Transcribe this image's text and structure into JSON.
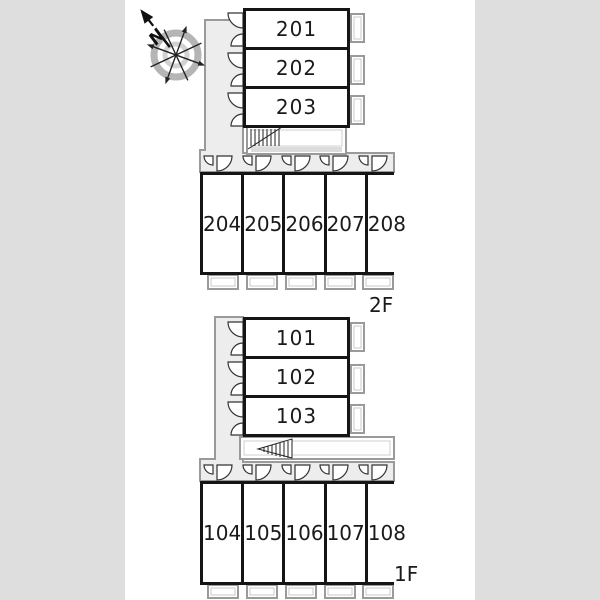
{
  "compass": {
    "label": "N"
  },
  "floors": [
    {
      "label": "2F",
      "corridor_rooms": [
        "201",
        "202",
        "203"
      ],
      "row_rooms": [
        "204",
        "205",
        "206",
        "207",
        "208"
      ]
    },
    {
      "label": "1F",
      "corridor_rooms": [
        "101",
        "102",
        "103"
      ],
      "row_rooms": [
        "104",
        "105",
        "106",
        "107",
        "108"
      ]
    }
  ],
  "colors": {
    "background": "#dedede",
    "paper": "#ffffff",
    "wall": "#151515",
    "corridor_fill": "#ededed",
    "outline_gray": "#9a9a9a"
  }
}
